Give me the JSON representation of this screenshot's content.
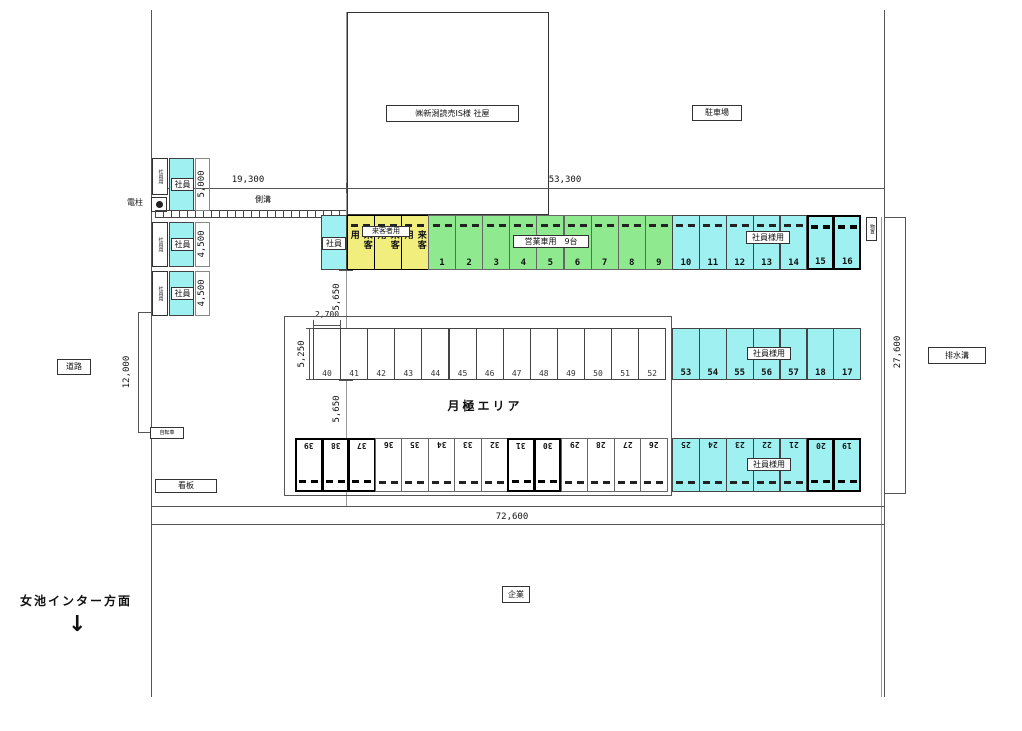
{
  "colors": {
    "cyan": "#9ff0f0",
    "yellow": "#f2ee7d",
    "green": "#8fe98f",
    "white": "#ffffff",
    "line": "#444444"
  },
  "drawing": {
    "building_label": "㈱新潟読売IS様 社屋",
    "parking_label": "駐車場",
    "road": "道路",
    "gutter": "側溝",
    "pole": "電柱",
    "signboard": "看板",
    "bicycle": "自転車",
    "drain": "排水溝",
    "company": "企業",
    "direction": "女池インター方面",
    "direction_arrow": "↓",
    "monthly_area": "月極エリア",
    "storage": "物置",
    "visitor_overlay": "来客者用",
    "business_overlay": "営業車用　9台",
    "staff_overlay": "社員様用"
  },
  "dims": {
    "d19300": "19,300",
    "d53300": "53,300",
    "d72600": "72,600",
    "d27600": "27,600",
    "d12000": "12,000",
    "d5000": "5,000",
    "d4500a": "4,500",
    "d4500b": "4,500",
    "d5650a": "5,650",
    "d5650b": "5,650",
    "d2700": "2,700",
    "d5250": "5,250"
  },
  "left_column": {
    "groups": [
      {
        "side_label": "社員用",
        "label": "社員",
        "dim": "5,000"
      },
      {
        "side_label": "社員用",
        "label": "社員",
        "dim": "4,500"
      },
      {
        "side_label": "社員用",
        "label": "社員",
        "dim": "4,500"
      }
    ]
  },
  "rows": {
    "row1": {
      "staff_label": "社員",
      "visitor_cells": [
        "来客用",
        "来客用",
        "来客用"
      ],
      "green": [
        "1",
        "2",
        "3",
        "4",
        "5",
        "6",
        "7",
        "8",
        "9"
      ],
      "cyan": [
        "10",
        "11",
        "12",
        "13",
        "14",
        "15",
        "16"
      ],
      "bold": [
        "15",
        "16"
      ]
    },
    "row2": {
      "white": [
        "40",
        "41",
        "42",
        "43",
        "44",
        "45",
        "46",
        "47",
        "48",
        "49",
        "50",
        "51",
        "52"
      ],
      "cyan": [
        "53",
        "54",
        "55",
        "56",
        "57",
        "18",
        "17"
      ]
    },
    "row3": {
      "white": [
        "39",
        "38",
        "37",
        "36",
        "35",
        "34",
        "33",
        "32",
        "31",
        "30",
        "29",
        "28",
        "27",
        "26"
      ],
      "cyan": [
        "25",
        "24",
        "23",
        "22",
        "21",
        "20",
        "19"
      ],
      "bold": [
        "39",
        "38",
        "37",
        "31",
        "30",
        "20",
        "19"
      ]
    }
  }
}
